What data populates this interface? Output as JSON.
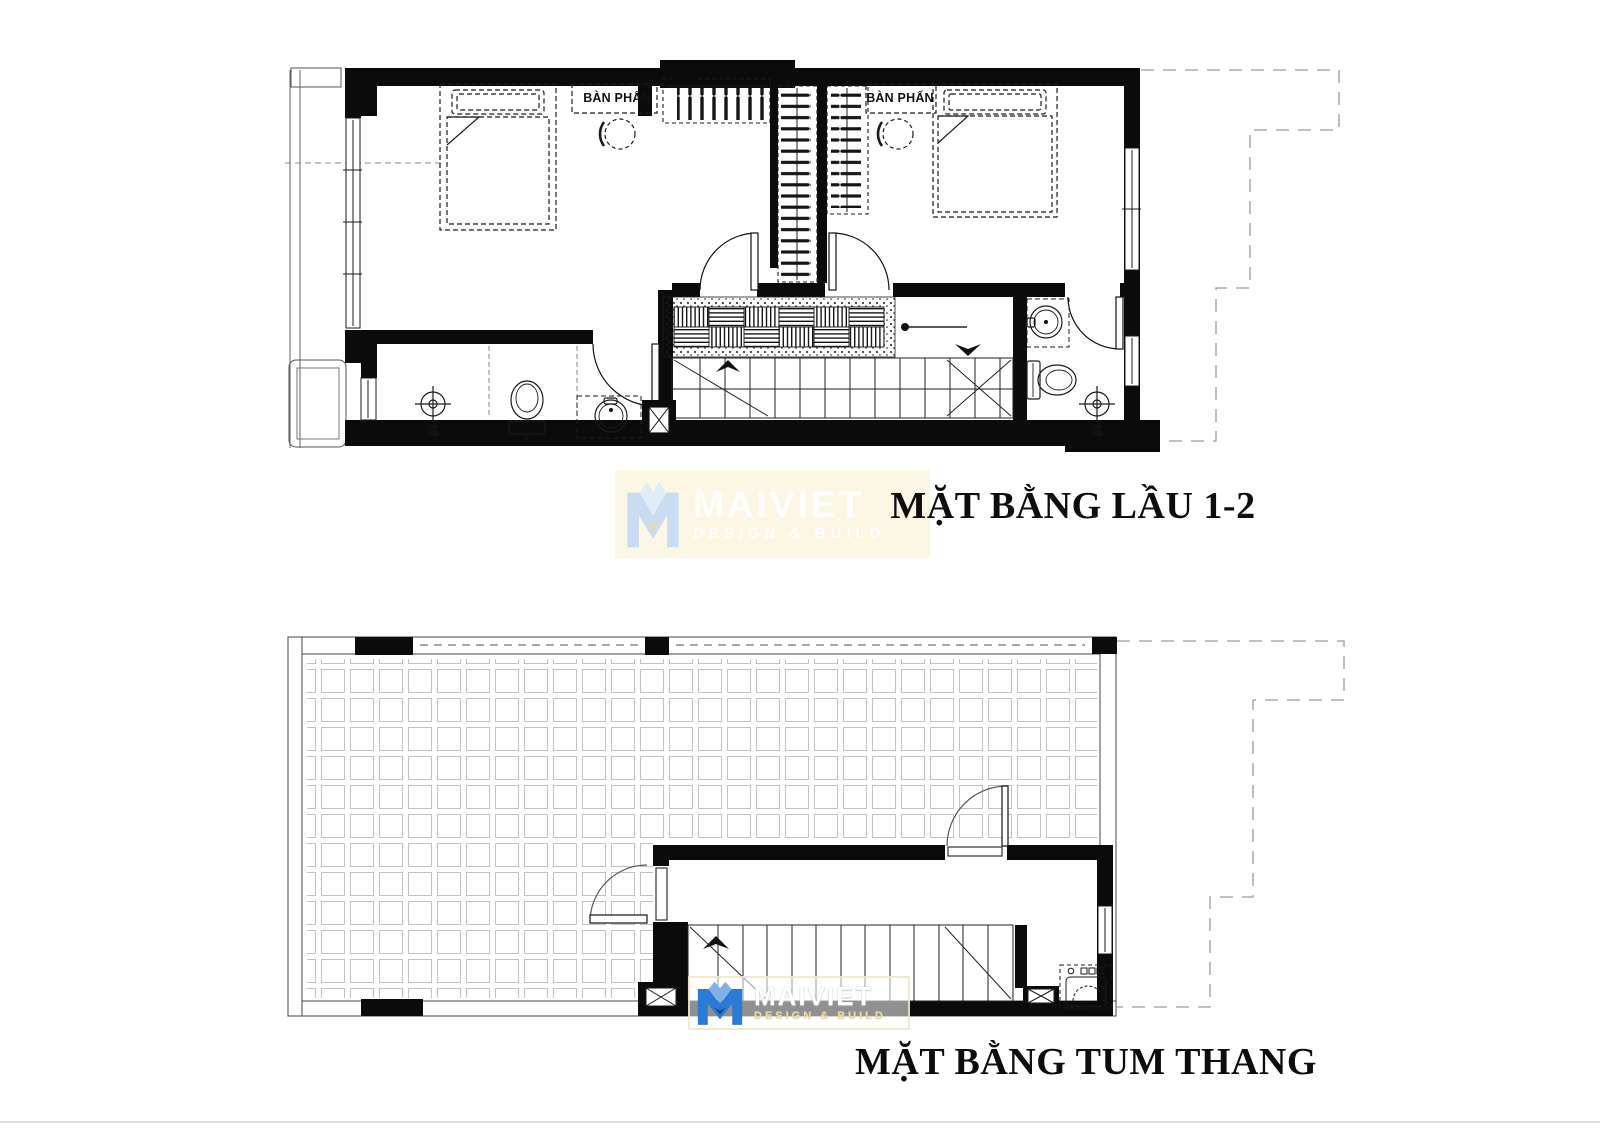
{
  "plans": {
    "upper": {
      "title": "MẶT BẰNG LẦU 1-2",
      "vanity_label_left": "BÀN PHẤN",
      "vanity_label_right": "BÀN PHẤN"
    },
    "lower": {
      "title": "MẶT BẰNG TUM THANG"
    }
  },
  "watermark": {
    "brand": "MAIVIET",
    "tagline": "DESIGN & BUILD"
  },
  "palette": {
    "wall_black": "#0b0b0b",
    "line_dark": "#1b1b1b",
    "tile_joint_gray": "#c2c2c2",
    "boundary_gray": "#9b9b9b",
    "logo_blue": "#2b7ad6",
    "logo_blue_dark": "#0c4288",
    "logo_blue_pale": "#c9dcf3",
    "watermark_cream": "#fcf6e4",
    "paper_white": "#ffffff"
  }
}
